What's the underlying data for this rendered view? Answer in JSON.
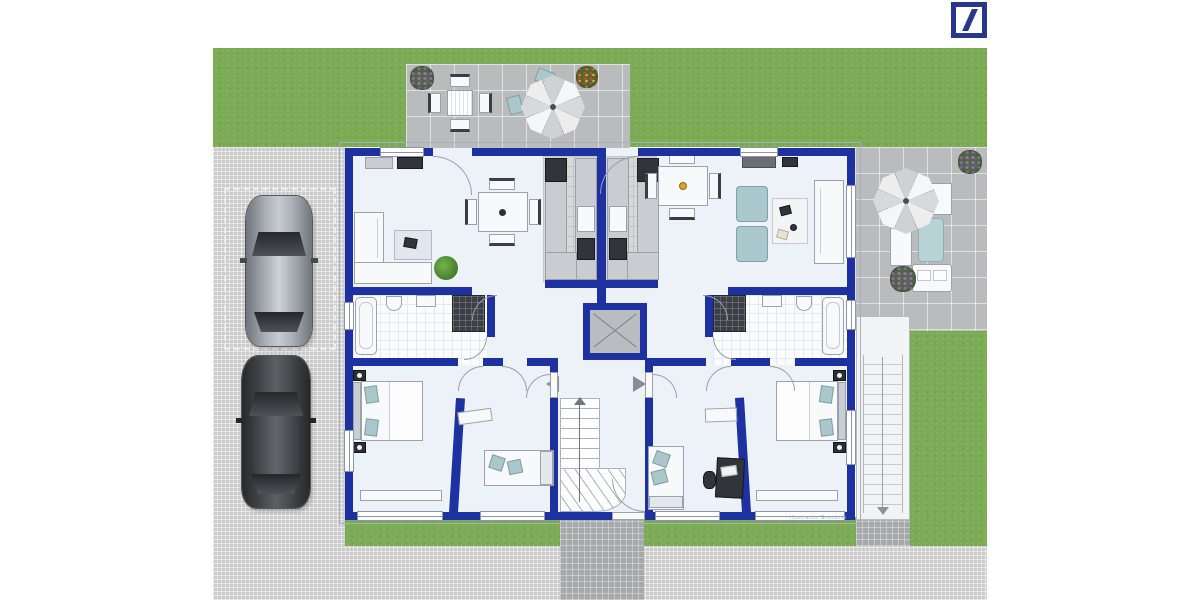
{
  "branding": {
    "logo_name": "deutsche-bank-slash-logo"
  },
  "watermark": {
    "text": "Illustration Grundriss"
  },
  "colors": {
    "wall": "#1d31a0",
    "floor": "#edf1f8",
    "grass": "#7cab55",
    "pavement": "#cbcbcb",
    "patio_tile": "#b9bbbd",
    "cobble": "#a6a8a9",
    "teal": "#aac7cc",
    "dark": "#31343a",
    "line": "#97a0b0",
    "db_blue": "#28368f",
    "watermark_color": "#9db1e0"
  },
  "scene": {
    "type": "two-unit-apartment-floor-plan",
    "areas": [
      "garden",
      "terrace-top",
      "terrace-right",
      "driveway",
      "parking-space",
      "exterior-stair",
      "entrance-path"
    ],
    "rooms_left_unit": [
      "living-room",
      "kitchen",
      "bathroom",
      "bedroom",
      "kids-room",
      "hallway"
    ],
    "rooms_right_unit": [
      "living-room",
      "kitchen",
      "bathroom",
      "bedroom",
      "office",
      "hallway"
    ],
    "shared": [
      "stairwell",
      "shaft"
    ],
    "vehicles": [
      "silver-car",
      "dark-car"
    ],
    "outdoor_items": [
      "parasol",
      "garden-table-set",
      "lounge-furniture",
      "flower-beds"
    ]
  }
}
